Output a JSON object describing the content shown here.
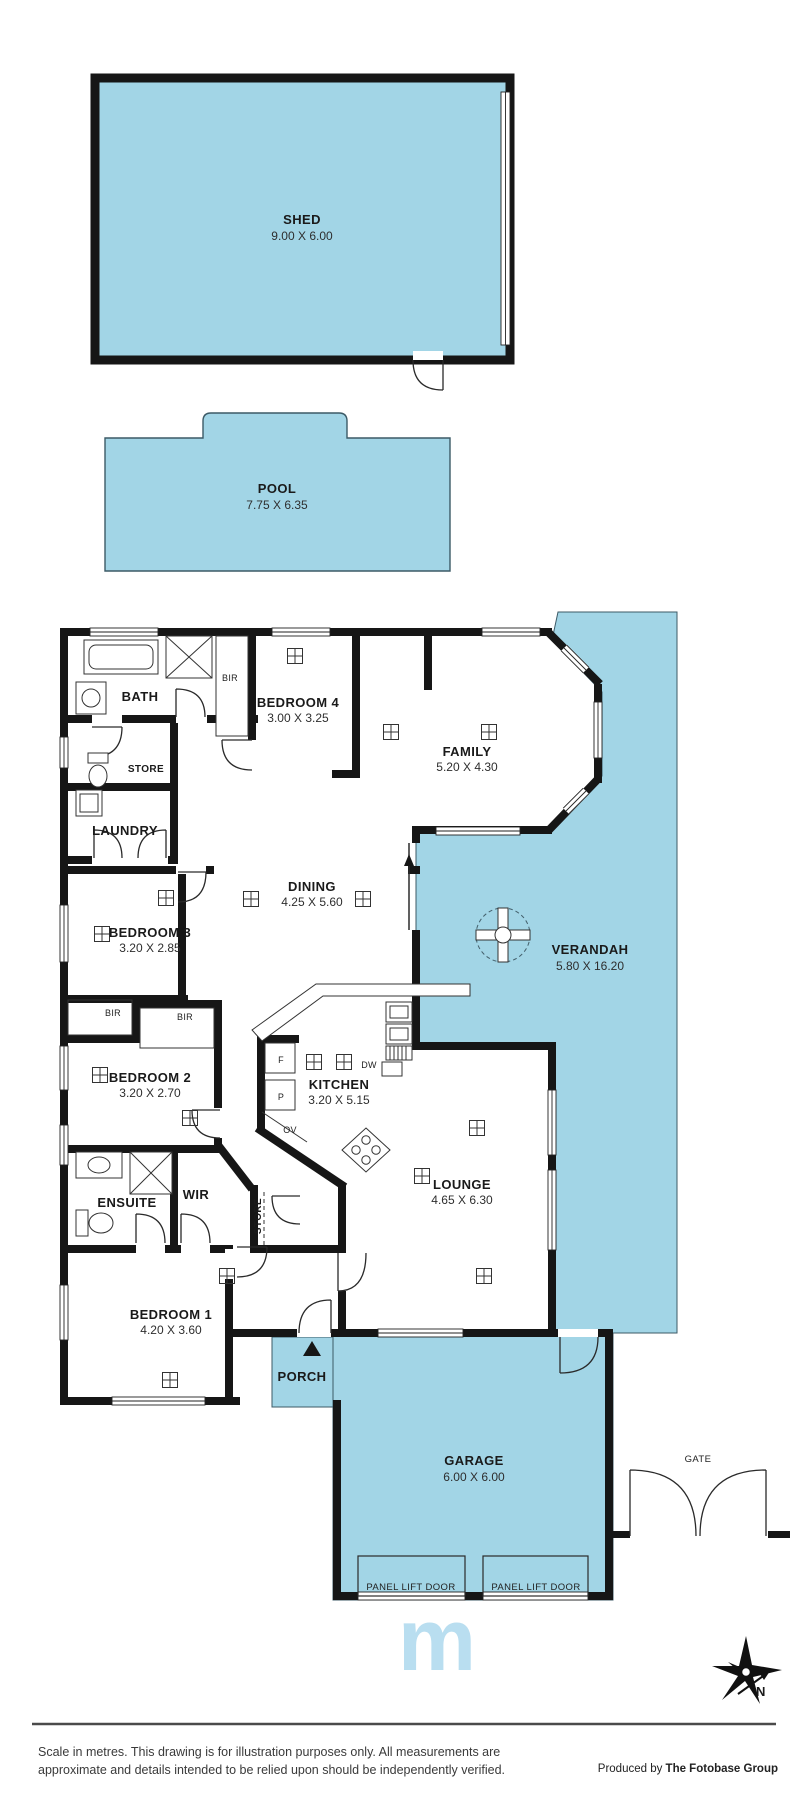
{
  "rooms": {
    "shed": {
      "name": "SHED",
      "dims": "9.00 X 6.00"
    },
    "pool": {
      "name": "POOL",
      "dims": "7.75 X 6.35"
    },
    "bath": {
      "name": "BATH"
    },
    "bir_top": {
      "name": "BIR"
    },
    "bedroom4": {
      "name": "BEDROOM 4",
      "dims": "3.00 X 3.25"
    },
    "family": {
      "name": "FAMILY",
      "dims": "5.20 X 4.30"
    },
    "store_top": {
      "name": "STORE"
    },
    "laundry": {
      "name": "LAUNDRY"
    },
    "dining": {
      "name": "DINING",
      "dims": "4.25 X 5.60"
    },
    "bedroom3": {
      "name": "BEDROOM 3",
      "dims": "3.20 X 2.85"
    },
    "verandah": {
      "name": "VERANDAH",
      "dims": "5.80 X 16.20"
    },
    "bir_left": {
      "name": "BIR"
    },
    "bir_right": {
      "name": "BIR"
    },
    "bedroom2": {
      "name": "BEDROOM 2",
      "dims": "3.20 X 2.70"
    },
    "kitchen": {
      "name": "KITCHEN",
      "dims": "3.20 X 5.15"
    },
    "ensuite": {
      "name": "ENSUITE"
    },
    "wir": {
      "name": "WIR"
    },
    "store_bottom": {
      "name": "STORE"
    },
    "lounge": {
      "name": "LOUNGE",
      "dims": "4.65 X 6.30"
    },
    "bedroom1": {
      "name": "BEDROOM 1",
      "dims": "4.20 X 3.60"
    },
    "porch": {
      "name": "PORCH"
    },
    "garage": {
      "name": "GARAGE",
      "dims": "6.00 X 6.00"
    },
    "gate": {
      "name": "GATE"
    }
  },
  "appliances": {
    "fridge": "F",
    "pantry": "P",
    "oven": "OV",
    "dishwasher": "DW"
  },
  "garage_doors": {
    "left": "PANEL LIFT DOOR",
    "right": "PANEL LIFT DOOR"
  },
  "watermark": "m",
  "compass": {
    "north_label": "N"
  },
  "footer": {
    "disclaimer_line1": "Scale in metres. This drawing is for illustration purposes only. All measurements are",
    "disclaimer_line2": "approximate and details intended to be relied upon should be independently verified.",
    "produced_by_prefix": "Produced by ",
    "produced_by_brand": "The Fotobase Group"
  },
  "colors": {
    "area_fill": "#a2d5e6",
    "wall": "#161616",
    "watermark": "#b9def0"
  }
}
